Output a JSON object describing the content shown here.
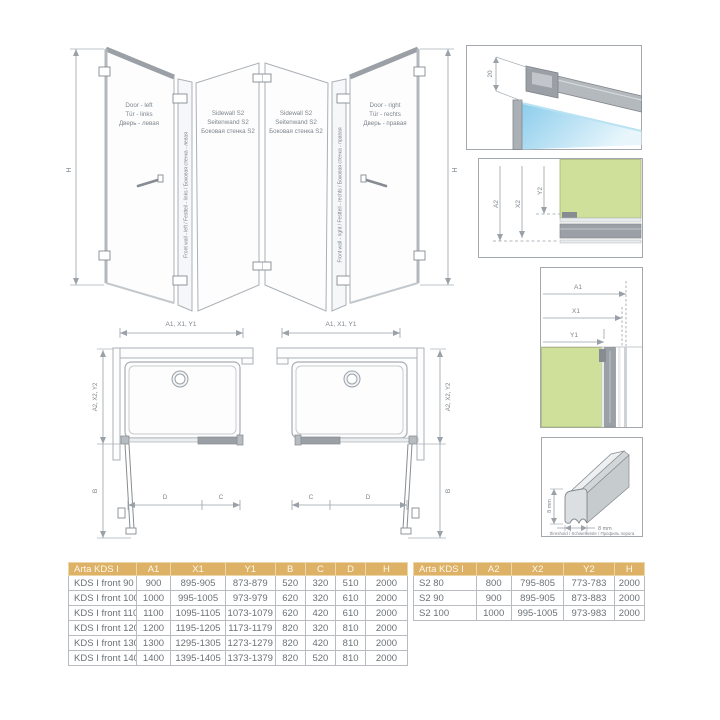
{
  "colors": {
    "table_header_bg": "#ddb166",
    "table_header_text": "#fdf8ec",
    "glass_blue": "#8ccdec",
    "wall_green": "#cfe09b",
    "profile_gray": "#9aa0a5",
    "line_gray": "#9aa1a8",
    "drawing_text": "#7e858c"
  },
  "enclosure_left": {
    "h": "H",
    "door_lines": [
      "Door - left",
      "Tür - links",
      "Дверь - левая"
    ],
    "sidewall_lines": [
      "Sidewall S2",
      "Seitenwand S2",
      "Боковая стенка S2"
    ],
    "front_wall_line": "Front wall - left / Festteil - links / Боковая стенка - левая"
  },
  "enclosure_right": {
    "h": "H",
    "door_lines": [
      "Door - right",
      "Tür - rechts",
      "Дверь - правая"
    ],
    "sidewall_lines": [
      "Sidewall S2",
      "Seitenwand S2",
      "Боковая стенка S2"
    ],
    "front_wall_line": "Front wall - right / Festteil - rechts / Боковая стенка - правая"
  },
  "plan_left": {
    "width_dim": "A1, X1, Y1",
    "depth_dim": "A2, X2, Y2",
    "b": "B",
    "d": "D",
    "c": "C"
  },
  "plan_right": {
    "width_dim": "A1, X1, Y1",
    "depth_dim": "A2, X2, Y2",
    "b": "B",
    "d": "D",
    "c": "C"
  },
  "detail_top": {
    "gap": "20"
  },
  "detail_sidewall": {
    "a2": "A2",
    "x2": "X2",
    "y2": "Y2"
  },
  "detail_front": {
    "a1": "A1",
    "x1": "X1",
    "y1": "Y1"
  },
  "detail_threshold": {
    "height": "8 mm",
    "width": "8 mm",
    "caption": "threshold / Schwellleiste / Профиль порога"
  },
  "table_front": {
    "headers": [
      "Arta KDS I",
      "A1",
      "X1",
      "Y1",
      "B",
      "C",
      "D",
      "H"
    ],
    "rows": [
      [
        "KDS I front 90",
        "900",
        "895-905",
        "873-879",
        "520",
        "320",
        "510",
        "2000"
      ],
      [
        "KDS I front 100",
        "1000",
        "995-1005",
        "973-979",
        "620",
        "320",
        "610",
        "2000"
      ],
      [
        "KDS I front 110",
        "1100",
        "1095-1105",
        "1073-1079",
        "620",
        "420",
        "610",
        "2000"
      ],
      [
        "KDS I front 120",
        "1200",
        "1195-1205",
        "1173-1179",
        "820",
        "320",
        "810",
        "2000"
      ],
      [
        "KDS I front 130",
        "1300",
        "1295-1305",
        "1273-1279",
        "820",
        "420",
        "810",
        "2000"
      ],
      [
        "KDS I front 140",
        "1400",
        "1395-1405",
        "1373-1379",
        "820",
        "520",
        "810",
        "2000"
      ]
    ]
  },
  "table_sidewall": {
    "headers": [
      "Arta KDS I",
      "A2",
      "X2",
      "Y2",
      "H"
    ],
    "rows": [
      [
        "S2 80",
        "800",
        "795-805",
        "773-783",
        "2000"
      ],
      [
        "S2 90",
        "900",
        "895-905",
        "873-883",
        "2000"
      ],
      [
        "S2 100",
        "1000",
        "995-1005",
        "973-983",
        "2000"
      ]
    ]
  }
}
